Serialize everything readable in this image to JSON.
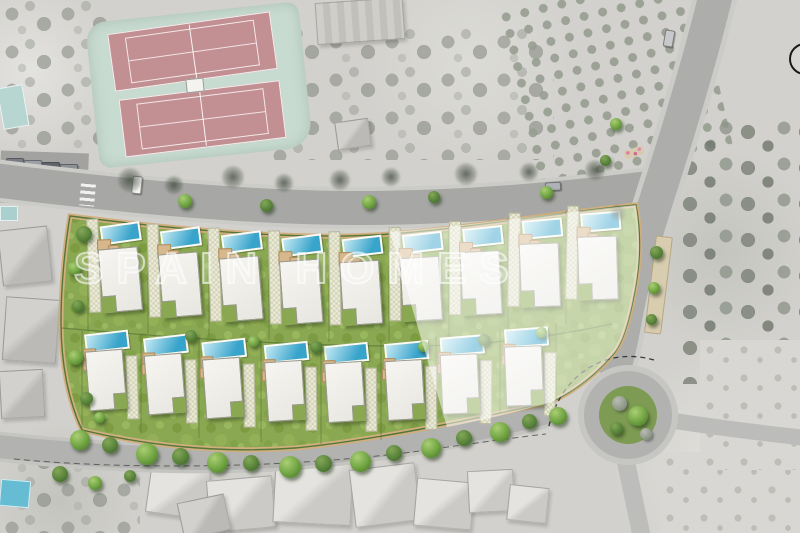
{
  "watermark": {
    "text": "SPAIN HOMES"
  },
  "development": {
    "type": "villa-site-plan-over-satellite",
    "villa_count_total": 17,
    "north_row_count": 9,
    "south_row_count": 8,
    "faded_section": "right portion of parcel shown faded"
  },
  "colors": {
    "grass": "#8aa851",
    "grass_dark": "#79993f",
    "grass_light": "#9cba60",
    "pool_light": "#c4e9f3",
    "pool_dark": "#39a4cb",
    "house": "#f2f1ec",
    "terrace": "#d6b88c",
    "driveway": "#eaead6",
    "boundary_path": "#d0ae7e",
    "hedge": "#54763a",
    "road": "#a7a7a5",
    "court": "#c28f92",
    "court_surround": "#c8dbd1",
    "fade_overlay": "rgba(255,255,255,0.52)"
  },
  "plots": {
    "north_row": [
      {
        "x": 88,
        "y": 222,
        "r": -5,
        "faded": false
      },
      {
        "x": 148,
        "y": 227,
        "r": -4,
        "faded": false
      },
      {
        "x": 209,
        "y": 231,
        "r": -4,
        "faded": false
      },
      {
        "x": 269,
        "y": 234,
        "r": -3,
        "faded": false
      },
      {
        "x": 329,
        "y": 235,
        "r": -2,
        "faded": false
      },
      {
        "x": 389,
        "y": 231,
        "r": -1,
        "faded": true
      },
      {
        "x": 449,
        "y": 225,
        "r": 0,
        "faded": true
      },
      {
        "x": 508,
        "y": 217,
        "r": 2,
        "faded": true
      },
      {
        "x": 566,
        "y": 210,
        "r": 3,
        "faded": true
      }
    ],
    "south_row": [
      {
        "x": 82,
        "y": 330,
        "r": -4,
        "faded": false
      },
      {
        "x": 141,
        "y": 334,
        "r": -4,
        "faded": false
      },
      {
        "x": 199,
        "y": 338,
        "r": -3,
        "faded": false
      },
      {
        "x": 261,
        "y": 341,
        "r": -2,
        "faded": false
      },
      {
        "x": 321,
        "y": 342,
        "r": -2,
        "faded": false
      },
      {
        "x": 381,
        "y": 340,
        "r": -1,
        "faded": false
      },
      {
        "x": 436,
        "y": 334,
        "r": 1,
        "faded": true
      },
      {
        "x": 500,
        "y": 326,
        "r": 2,
        "faded": true
      }
    ]
  },
  "dividers": [
    [
      88,
      222,
      88,
      331
    ],
    [
      148,
      226,
      148,
      334
    ],
    [
      209,
      230,
      209,
      337
    ],
    [
      269,
      233,
      269,
      340
    ],
    [
      329,
      235,
      329,
      342
    ],
    [
      389,
      232,
      389,
      341
    ],
    [
      449,
      226,
      449,
      337
    ],
    [
      508,
      218,
      508,
      330
    ],
    [
      566,
      211,
      566,
      324
    ],
    [
      82,
      331,
      82,
      429
    ],
    [
      141,
      334,
      141,
      434
    ],
    [
      199,
      337,
      199,
      438
    ],
    [
      261,
      340,
      261,
      442
    ],
    [
      321,
      342,
      321,
      444
    ],
    [
      381,
      340,
      381,
      440
    ],
    [
      436,
      336,
      436,
      430
    ],
    [
      500,
      329,
      500,
      414
    ],
    [
      556,
      323,
      556,
      400
    ]
  ],
  "trees": {
    "road_row": [
      [
        70,
        430,
        20,
        "g"
      ],
      [
        102,
        437,
        16,
        "d"
      ],
      [
        136,
        443,
        22,
        "g"
      ],
      [
        172,
        448,
        17,
        "d"
      ],
      [
        207,
        452,
        21,
        "g"
      ],
      [
        243,
        455,
        16,
        "d"
      ],
      [
        279,
        456,
        22,
        "g"
      ],
      [
        315,
        455,
        17,
        "d"
      ],
      [
        350,
        451,
        21,
        "g"
      ],
      [
        386,
        445,
        16,
        "d"
      ],
      [
        421,
        438,
        20,
        "g"
      ],
      [
        456,
        430,
        16,
        "d"
      ],
      [
        490,
        422,
        20,
        "g"
      ],
      [
        522,
        414,
        15,
        "d"
      ],
      [
        549,
        407,
        18,
        "g"
      ]
    ],
    "south_side": [
      [
        52,
        466,
        16,
        "d"
      ],
      [
        88,
        476,
        14,
        "g"
      ],
      [
        124,
        470,
        12,
        "d"
      ]
    ],
    "top_road": [
      [
        178,
        194,
        14,
        "g"
      ],
      [
        260,
        199,
        13,
        "d"
      ],
      [
        362,
        195,
        14,
        "g"
      ],
      [
        428,
        191,
        12,
        "d"
      ],
      [
        540,
        186,
        13,
        "g"
      ]
    ],
    "shadows": [
      [
        118,
        168,
        24
      ],
      [
        165,
        176,
        18
      ],
      [
        222,
        166,
        22
      ],
      [
        275,
        174,
        18
      ],
      [
        330,
        170,
        20
      ],
      [
        382,
        168,
        18
      ],
      [
        455,
        163,
        22
      ],
      [
        520,
        163,
        18
      ],
      [
        585,
        160,
        20
      ],
      [
        610,
        205,
        16
      ]
    ],
    "parcel": [
      [
        76,
        226,
        16,
        "d"
      ],
      [
        68,
        262,
        13,
        "g"
      ],
      [
        72,
        300,
        12,
        "d"
      ],
      [
        68,
        350,
        15,
        "g"
      ],
      [
        80,
        392,
        13,
        "d"
      ],
      [
        94,
        412,
        11,
        "g"
      ],
      [
        185,
        330,
        12,
        "d"
      ],
      [
        248,
        336,
        11,
        "g"
      ],
      [
        310,
        341,
        12,
        "d"
      ],
      [
        418,
        341,
        11,
        "g"
      ],
      [
        478,
        334,
        12,
        "d"
      ],
      [
        536,
        327,
        11,
        "g"
      ]
    ],
    "median": [
      [
        650,
        246,
        13,
        "d"
      ],
      [
        648,
        282,
        12,
        "g"
      ],
      [
        646,
        314,
        11,
        "d"
      ],
      [
        610,
        118,
        12,
        "g"
      ],
      [
        600,
        155,
        11,
        "d"
      ]
    ],
    "roundabout": [
      [
        612,
        396,
        15,
        "gray"
      ],
      [
        628,
        406,
        20,
        "g"
      ],
      [
        610,
        422,
        13,
        "d"
      ],
      [
        640,
        428,
        12,
        "gray"
      ]
    ]
  },
  "context": {
    "buildings": [
      {
        "x": 148,
        "y": 468,
        "w": 58,
        "h": 46,
        "r": 8,
        "tone": ""
      },
      {
        "x": 208,
        "y": 478,
        "w": 64,
        "h": 50,
        "r": -5,
        "tone": ""
      },
      {
        "x": 274,
        "y": 462,
        "w": 76,
        "h": 60,
        "r": 3,
        "tone": ""
      },
      {
        "x": 352,
        "y": 466,
        "w": 64,
        "h": 56,
        "r": -7,
        "tone": ""
      },
      {
        "x": 415,
        "y": 480,
        "w": 56,
        "h": 46,
        "r": 5,
        "tone": ""
      },
      {
        "x": 468,
        "y": 470,
        "w": 44,
        "h": 40,
        "r": -3,
        "tone": ""
      },
      {
        "x": 508,
        "y": 486,
        "w": 38,
        "h": 34,
        "r": 6,
        "tone": ""
      },
      {
        "x": 180,
        "y": 498,
        "w": 46,
        "h": 35,
        "r": -12,
        "tone": "dark"
      },
      {
        "x": 0,
        "y": 228,
        "w": 48,
        "h": 54,
        "r": -6,
        "tone": "dark"
      },
      {
        "x": 4,
        "y": 298,
        "w": 52,
        "h": 62,
        "r": 4,
        "tone": "dark"
      },
      {
        "x": 0,
        "y": 370,
        "w": 42,
        "h": 46,
        "r": -3,
        "tone": "dark"
      },
      {
        "x": 316,
        "y": 0,
        "w": 86,
        "h": 40,
        "r": -4,
        "tone": "ridged"
      },
      {
        "x": 336,
        "y": 120,
        "w": 32,
        "h": 26,
        "r": -8,
        "tone": "dark"
      }
    ],
    "cars_parked": [
      {
        "x": 6,
        "y": 158,
        "c": "#787d83"
      },
      {
        "x": 24,
        "y": 160,
        "c": "#9aa0a6"
      },
      {
        "x": 42,
        "y": 162,
        "c": "#5f646b"
      },
      {
        "x": 60,
        "y": 164,
        "c": "#8d9196"
      }
    ],
    "cars_road": [
      {
        "x": 132,
        "y": 176,
        "w": 8,
        "h": 16,
        "r": 6,
        "c": "#f4f4f2"
      },
      {
        "x": 664,
        "y": 30,
        "w": 8,
        "h": 15,
        "r": 10,
        "c": "#c7c9cc"
      },
      {
        "x": 545,
        "y": 182,
        "w": 14,
        "h": 7,
        "r": -3,
        "c": "#aeb2b8"
      }
    ],
    "pools": [
      {
        "x": 0,
        "y": 86,
        "w": 24,
        "h": 40,
        "r": -10,
        "c": "#b7d6d2"
      },
      {
        "x": 0,
        "y": 480,
        "w": 28,
        "h": 25,
        "r": 5,
        "c": "#66bdd3"
      },
      {
        "x": 0,
        "y": 206,
        "w": 16,
        "h": 13,
        "r": 0,
        "c": "#a9cfcf"
      }
    ]
  },
  "tennis": {
    "surround": {
      "x": 92,
      "y": 12,
      "w": 214,
      "h": 146,
      "r": -6
    },
    "courts": [
      {
        "x": 22,
        "y": 10,
        "w": 162,
        "h": 56,
        "r": -2
      },
      {
        "x": 26,
        "y": 78,
        "w": 160,
        "h": 56,
        "r": -1
      }
    ],
    "hut": {
      "x": 94,
      "y": 66,
      "w": 16,
      "h": 12
    }
  }
}
